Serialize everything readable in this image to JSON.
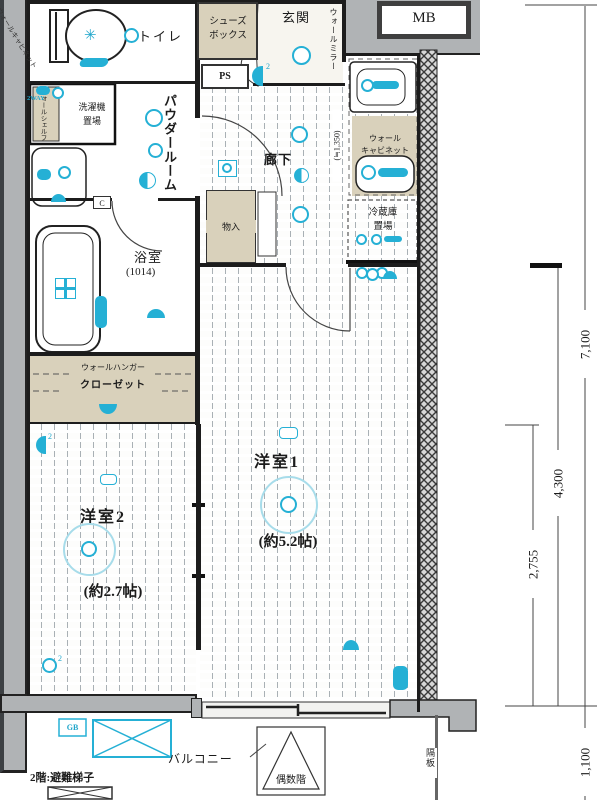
{
  "plan": {
    "rooms": {
      "toilet": "トイレ",
      "entrance": "玄関",
      "shoebox1": "シューズ",
      "shoebox2": "ボックス",
      "powder": "パウダールーム",
      "hallway": "廊下",
      "bath": "浴室",
      "bath_size": "(1014)",
      "room1": "洋室1",
      "room1_size": "(約5.2帖)",
      "room2": "洋室2",
      "room2_size": "(約2.7帖)",
      "storage": "物入",
      "balcony": "バルコニー"
    },
    "fixtures": {
      "ps": "PS",
      "mb": "MB",
      "gb": "GB",
      "washer1": "洗濯機",
      "washer2": "置場",
      "fridge1": "冷蔵庫",
      "fridge2": "置場",
      "kcab1": "ウォール",
      "kcab2": "キャビネット",
      "mirror": "ウォールミラー",
      "wcab": "ウォールキャビネット",
      "wshelf": "ウォールシェルフ",
      "closet1": "ウォールハンガー",
      "closet2": "クローゼット",
      "two_way": "2WAY",
      "c": "C",
      "n2": "2"
    },
    "notes": {
      "escape": "2階:避難梯子",
      "even": "偶数階",
      "partition": "隔板"
    },
    "dims": {
      "h_total": "7,100",
      "h_room1": "4,300",
      "h_room2": "2,755",
      "balcony": "1,100",
      "hall": "(≒1,350)"
    },
    "icons": {
      "ceiling_light": "donut-circle",
      "downlight": "semi-circle",
      "outlet": "double-circle",
      "faucet": "cyan-blob",
      "bath_jet": "cross-box"
    },
    "colors": {
      "accent_cyan": "#25b0d5",
      "beige": "#d9d1bb",
      "wall_gray": "#b0b3b5",
      "line": "#1c1c1c"
    }
  }
}
